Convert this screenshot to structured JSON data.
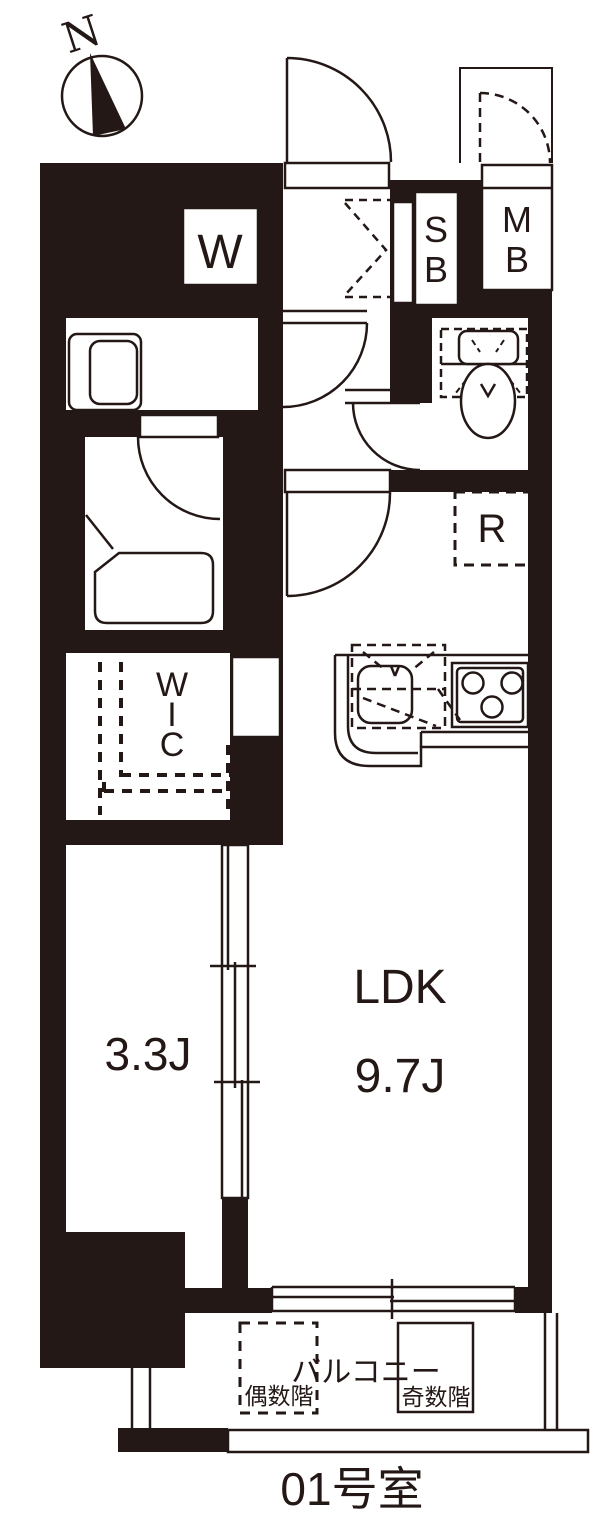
{
  "title": {
    "room_number": "01号室"
  },
  "compass": {
    "north": "N"
  },
  "fixtures": {
    "washing_machine": "W",
    "shoe_box": {
      "line1": "S",
      "line2": "B"
    },
    "meter_box": {
      "line1": "M",
      "line2": "B"
    },
    "refrigerator": "R"
  },
  "rooms": {
    "ldk": {
      "name": "LDK",
      "size": "9.7J"
    },
    "western_room": {
      "size": "3.3J"
    },
    "wic": {
      "line1": "W",
      "line2": "I",
      "line3": "C"
    },
    "balcony": {
      "name": "バルコニー",
      "even_floor_note": "偶数階",
      "odd_floor_note": "奇数階"
    }
  },
  "colors": {
    "wall": "#231815",
    "background": "#ffffff"
  }
}
